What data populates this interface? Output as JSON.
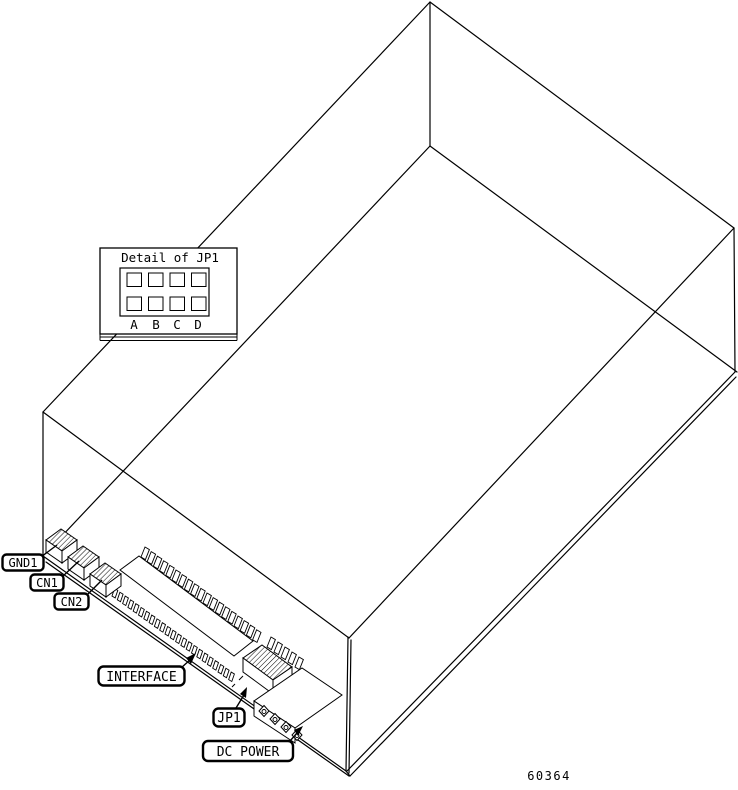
{
  "figure_number": "60364",
  "inset": {
    "title": "Detail of JP1",
    "pins": [
      "A",
      "B",
      "C",
      "D"
    ]
  },
  "callouts": {
    "gnd1": "GND1",
    "cn1": "CN1",
    "cn2": "CN2",
    "interface": "INTERFACE",
    "jp1": "JP1",
    "dc_power": "DC POWER"
  },
  "colors": {
    "line": "#000000",
    "background": "#ffffff"
  }
}
